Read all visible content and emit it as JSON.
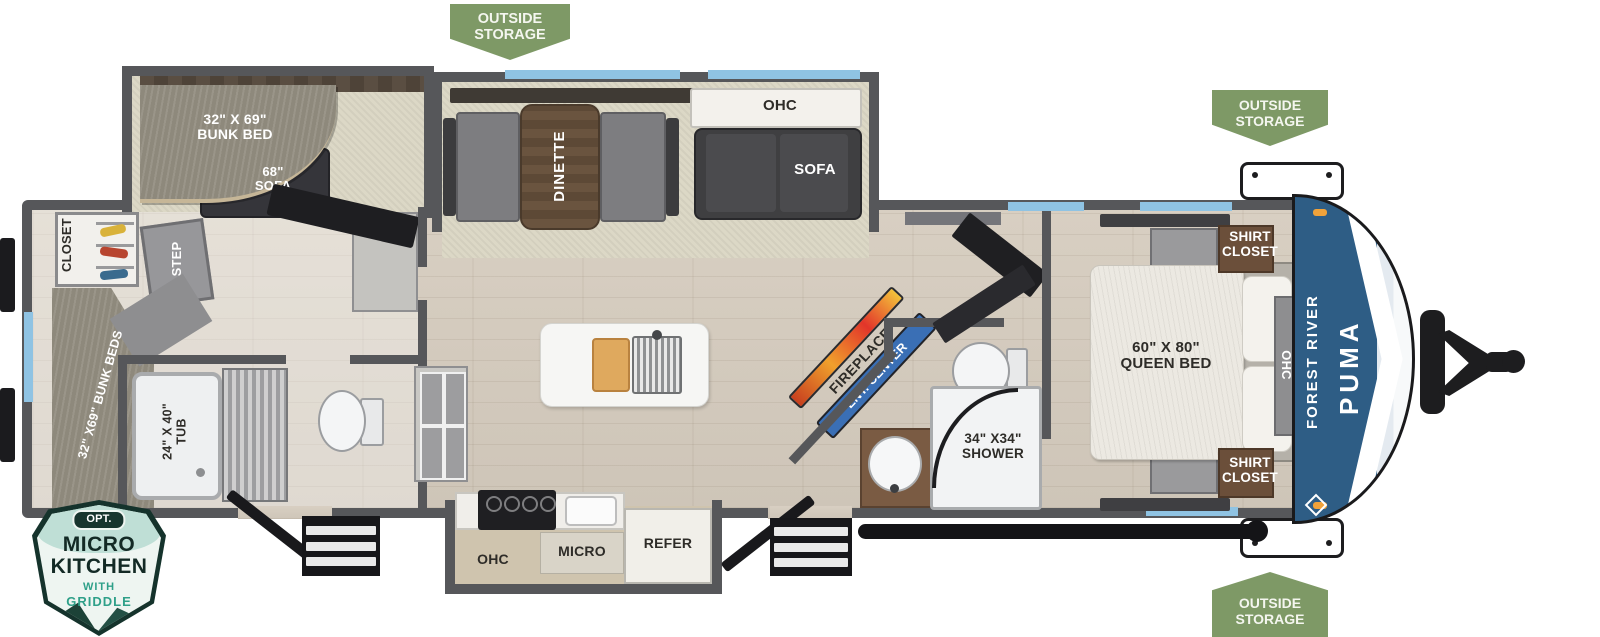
{
  "badges": {
    "outside_storage": {
      "line1": "OUTSIDE",
      "line2": "STORAGE"
    },
    "micro_kitchen": {
      "opt": "OPT.",
      "title1": "MICRO",
      "title2": "KITCHEN",
      "sub1": "WITH",
      "sub2": "GRIDDLE"
    }
  },
  "brand": {
    "manufacturer": "FOREST RIVER",
    "model": "PUMA"
  },
  "rooms": {
    "closet": "CLOSET",
    "step": "STEP",
    "rear_bunks": "32\" X69\" BUNK BEDS",
    "tub_l1": "24\" X 40\"",
    "tub_l2": "TUB",
    "bunk_bed_l1": "32\" X 69\"",
    "bunk_bed_l2": "BUNK BED",
    "bunk_sofa_l1": "68\"",
    "bunk_sofa_l2": "SOFA",
    "dinette": "DINETTE",
    "living_ohc": "OHC",
    "living_sofa": "SOFA",
    "fireplace": "FIREPLACE",
    "ent_center": "ENT. CENTER",
    "shower_l1": "34\" X34\"",
    "shower_l2": "SHOWER",
    "shirt_l1": "SHIRT",
    "shirt_l2": "CLOSET",
    "queen_l1": "60\" X 80\"",
    "queen_l2": "QUEEN BED",
    "bedroom_ohc": "OHC",
    "kitchen_ohc": "OHC",
    "micro": "MICRO",
    "refer": "REFER"
  },
  "colors": {
    "wall": "#56575a",
    "window_accent": "#8fc3e3",
    "badge_green": "#7e9966",
    "cap_blue": "#33638c",
    "ent_center_blue": "#3a6fb5",
    "teal": "#2fa089",
    "dark_teal": "#16332c"
  }
}
